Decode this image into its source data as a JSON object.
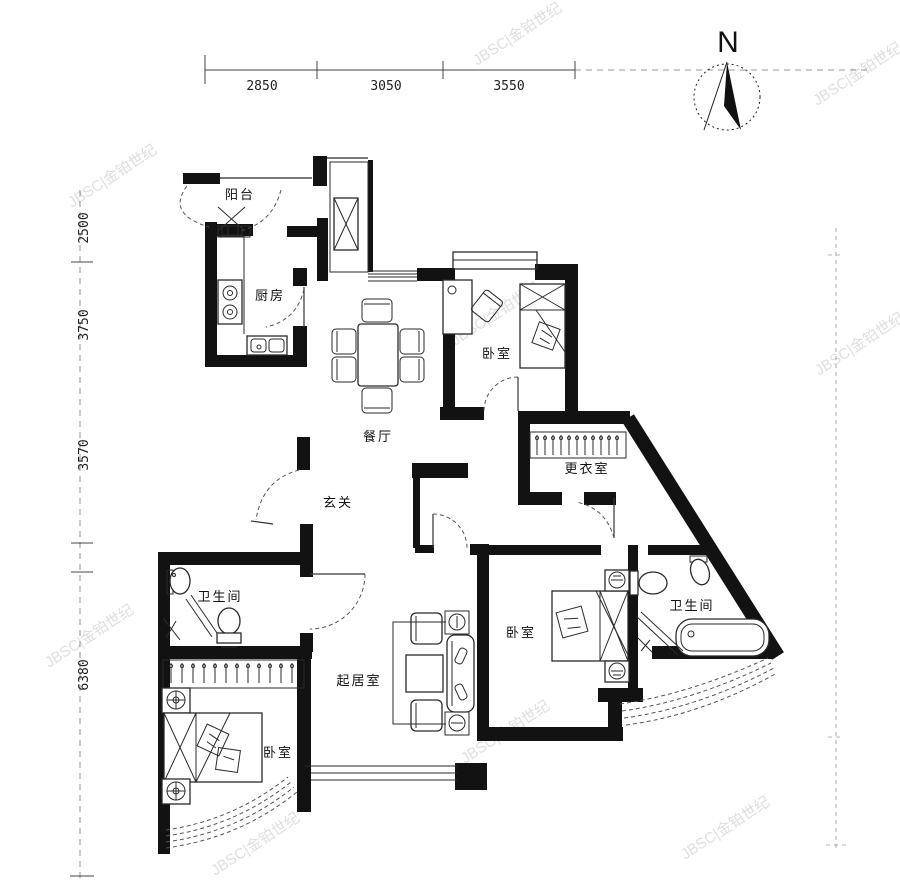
{
  "north_label": "N",
  "watermark": "JBSC|金铂世纪",
  "dims_top": [
    "2850",
    "3050",
    "3550"
  ],
  "dims_left": [
    "2500",
    "3750",
    "3570",
    "6380"
  ],
  "rooms": {
    "balcony": "阳台",
    "kitchen": "厨房",
    "dining": "餐厅",
    "entry": "玄关",
    "dressing": "更衣室",
    "living": "起居室",
    "bedroom_ne": "卧室",
    "bedroom_e": "卧室",
    "bedroom_sw": "卧室",
    "bath_w": "卫生间",
    "bath_e": "卫生间"
  },
  "colors": {
    "line": "#121212",
    "watermark": "#c9c9c9",
    "background": "#ffffff"
  }
}
